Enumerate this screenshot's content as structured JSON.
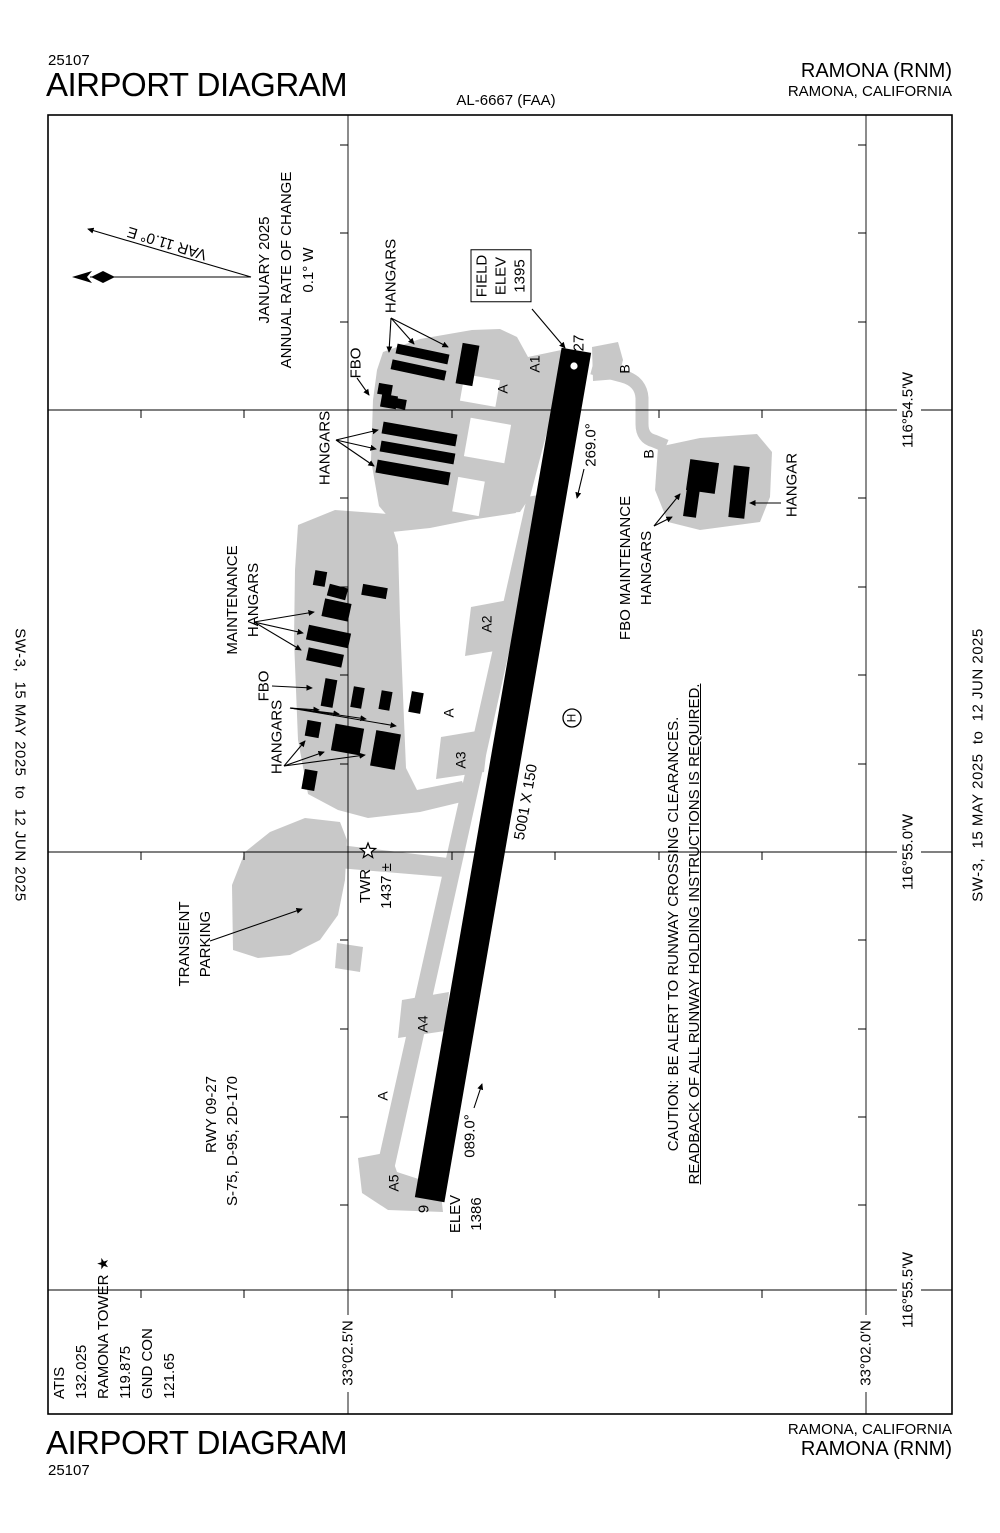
{
  "colors": {
    "paper": "#ffffff",
    "ink": "#000000",
    "apron": "#c8c8c8"
  },
  "header": {
    "chart_number": "25107",
    "title": "AIRPORT DIAGRAM",
    "al_number": "AL-6667 (FAA)",
    "airport_line": "RAMONA (RNM)",
    "city": "RAMONA, CALIFORNIA"
  },
  "footer": {
    "chart_number": "25107",
    "title": "AIRPORT DIAGRAM",
    "airport_line": "RAMONA (RNM)",
    "city": "RAMONA, CALIFORNIA"
  },
  "edges": {
    "left_date": "SW-3,  15 MAY 2025  to  12 JUN 2025",
    "right_date": "SW-3,  15 MAY 2025  to  12 JUN 2025"
  },
  "map": {
    "labels": [
      {
        "name": "annual-rate-note",
        "x": 287,
        "y": 270,
        "rot": -90,
        "size": 15,
        "align": "center",
        "lh": 22,
        "lines": [
          {
            "t": "JANUARY 2025"
          },
          {
            "t": "ANNUAL RATE OF CHANGE"
          },
          {
            "t": "0.1° W"
          }
        ]
      },
      {
        "name": "variation-label",
        "x": 167,
        "y": 243,
        "rot": -163,
        "size": 15,
        "lines": [
          {
            "t": "VAR 11.0° E"
          }
        ]
      },
      {
        "name": "fbo-north-label",
        "x": 356,
        "y": 363,
        "rot": -90,
        "size": 15,
        "lines": [
          {
            "t": "FBO"
          }
        ]
      },
      {
        "name": "hangars-north-label",
        "x": 391,
        "y": 276,
        "rot": -90,
        "size": 15,
        "lines": [
          {
            "t": "HANGARS"
          }
        ]
      },
      {
        "name": "hangars-west-label",
        "x": 325,
        "y": 448,
        "rot": -90,
        "size": 15,
        "lines": [
          {
            "t": "HANGARS"
          }
        ]
      },
      {
        "name": "maintenance-hangars-label",
        "x": 243,
        "y": 600,
        "rot": -90,
        "size": 15,
        "align": "center",
        "lh": 21,
        "lines": [
          {
            "t": "MAINTENANCE"
          },
          {
            "t": "HANGARS"
          }
        ]
      },
      {
        "name": "fbo-mid-label",
        "x": 264,
        "y": 686,
        "rot": -90,
        "size": 15,
        "lines": [
          {
            "t": "FBO"
          }
        ]
      },
      {
        "name": "hangars-mid-label",
        "x": 277,
        "y": 737,
        "rot": -90,
        "size": 15,
        "lines": [
          {
            "t": "HANGARS"
          }
        ]
      },
      {
        "name": "transient-parking-label",
        "x": 195,
        "y": 944,
        "rot": -90,
        "size": 15,
        "align": "center",
        "lh": 21,
        "lines": [
          {
            "t": "TRANSIENT"
          },
          {
            "t": "PARKING"
          }
        ]
      },
      {
        "name": "tower-label",
        "x": 376,
        "y": 886,
        "rot": -90,
        "size": 15,
        "align": "center",
        "lh": 21,
        "lines": [
          {
            "t": "TWR"
          },
          {
            "t": "1437 ±"
          }
        ]
      },
      {
        "name": "field-elev-box",
        "x": 501,
        "y": 276,
        "rot": -90,
        "size": 15,
        "align": "center",
        "lh": 19,
        "boxed": true,
        "lines": [
          {
            "t": "FIELD"
          },
          {
            "t": "ELEV"
          },
          {
            "t": "1395"
          }
        ]
      },
      {
        "name": "runway-data-label",
        "x": 222,
        "y": 1141,
        "rot": -90,
        "size": 15,
        "align": "right",
        "lh": 21,
        "lines": [
          {
            "t": "RWY 09-27"
          },
          {
            "t": "S-75, D-95, 2D-170"
          }
        ]
      },
      {
        "name": "caution-note",
        "x": 684,
        "y": 934,
        "rot": -90,
        "size": 15,
        "align": "center",
        "lh": 21,
        "lines": [
          {
            "t": "CAUTION: BE ALERT TO RUNWAY CROSSING CLEARANCES."
          },
          {
            "t": "READBACK OF ALL RUNWAY HOLDING INSTRUCTIONS IS REQUIRED.",
            "u": true
          }
        ]
      },
      {
        "name": "runway-dimension-label",
        "x": 526,
        "y": 802,
        "rot": -80,
        "size": 15,
        "lines": [
          {
            "t": "5001 X 150"
          }
        ]
      },
      {
        "name": "heading-269-label",
        "x": 591,
        "y": 445,
        "rot": -90,
        "size": 15,
        "lines": [
          {
            "t": "269.0°"
          }
        ]
      },
      {
        "name": "heading-089-label",
        "x": 470,
        "y": 1136,
        "rot": -90,
        "size": 15,
        "lines": [
          {
            "t": "089.0°"
          }
        ]
      },
      {
        "name": "threshold-27-label",
        "x": 579,
        "y": 343,
        "rot": -90,
        "size": 15,
        "lines": [
          {
            "t": "27"
          }
        ]
      },
      {
        "name": "threshold-9-label",
        "x": 424,
        "y": 1209,
        "rot": -90,
        "size": 15,
        "lines": [
          {
            "t": "9"
          }
        ]
      },
      {
        "name": "elev-9-label",
        "x": 466,
        "y": 1214,
        "rot": -90,
        "size": 15,
        "align": "center",
        "lh": 21,
        "lines": [
          {
            "t": "ELEV"
          },
          {
            "t": "1386"
          }
        ]
      },
      {
        "name": "taxiway-a1-label",
        "x": 535,
        "y": 364,
        "rot": -90,
        "size": 14,
        "lines": [
          {
            "t": "A1"
          }
        ]
      },
      {
        "name": "taxiway-a-north-label",
        "x": 503,
        "y": 389,
        "rot": -90,
        "size": 14,
        "lines": [
          {
            "t": "A"
          }
        ]
      },
      {
        "name": "taxiway-a2-label",
        "x": 487,
        "y": 624,
        "rot": -90,
        "size": 14,
        "lines": [
          {
            "t": "A2"
          }
        ]
      },
      {
        "name": "taxiway-a-mid-label",
        "x": 449,
        "y": 713,
        "rot": -90,
        "size": 14,
        "lines": [
          {
            "t": "A"
          }
        ]
      },
      {
        "name": "taxiway-a3-label",
        "x": 461,
        "y": 760,
        "rot": -90,
        "size": 14,
        "lines": [
          {
            "t": "A3"
          }
        ]
      },
      {
        "name": "taxiway-a4-label",
        "x": 423,
        "y": 1024,
        "rot": -90,
        "size": 14,
        "lines": [
          {
            "t": "A4"
          }
        ]
      },
      {
        "name": "taxiway-a-south-label",
        "x": 383,
        "y": 1096,
        "rot": -90,
        "size": 14,
        "lines": [
          {
            "t": "A"
          }
        ]
      },
      {
        "name": "taxiway-a5-label",
        "x": 394,
        "y": 1183,
        "rot": -90,
        "size": 14,
        "lines": [
          {
            "t": "A5"
          }
        ]
      },
      {
        "name": "taxiway-b-north-label",
        "x": 625,
        "y": 369,
        "rot": -90,
        "size": 14,
        "lines": [
          {
            "t": "B"
          }
        ]
      },
      {
        "name": "taxiway-b-south-label",
        "x": 649,
        "y": 454,
        "rot": -90,
        "size": 14,
        "lines": [
          {
            "t": "B"
          }
        ]
      },
      {
        "name": "helipad-h-label",
        "x": 572,
        "y": 718,
        "rot": -90,
        "size": 12,
        "lines": [
          {
            "t": "H"
          }
        ]
      },
      {
        "name": "fbo-maintenance-label",
        "x": 636,
        "y": 568,
        "rot": -90,
        "size": 15,
        "align": "center",
        "lh": 21,
        "lines": [
          {
            "t": "FBO MAINTENANCE"
          },
          {
            "t": "HANGARS"
          }
        ]
      },
      {
        "name": "se-hangar-label",
        "x": 792,
        "y": 485,
        "rot": -90,
        "size": 15,
        "lines": [
          {
            "t": "HANGAR"
          }
        ]
      },
      {
        "name": "lat-33-02-5-label",
        "x": 348,
        "y": 1353,
        "rot": -90,
        "size": 15,
        "lines": [
          {
            "t": "33°02.5′N"
          }
        ]
      },
      {
        "name": "lat-33-02-0-label",
        "x": 866,
        "y": 1353,
        "rot": -90,
        "size": 15,
        "lines": [
          {
            "t": "33°02.0′N"
          }
        ]
      },
      {
        "name": "lon-116-54-5-label",
        "x": 908,
        "y": 410,
        "rot": -90,
        "size": 15,
        "lines": [
          {
            "t": "116°54.5′W"
          }
        ]
      },
      {
        "name": "lon-116-55-0-label",
        "x": 908,
        "y": 852,
        "rot": -90,
        "size": 15,
        "lines": [
          {
            "t": "116°55.0′W"
          }
        ]
      },
      {
        "name": "lon-116-55-5-label",
        "x": 908,
        "y": 1290,
        "rot": -90,
        "size": 15,
        "lines": [
          {
            "t": "116°55.5′W"
          }
        ]
      },
      {
        "name": "comm-frequencies",
        "x": 115,
        "y": 1328,
        "rot": -90,
        "size": 15,
        "align": "left",
        "lh": 22,
        "lines": [
          {
            "t": "ATIS"
          },
          {
            "t": "132.025"
          },
          {
            "t": "RAMONA TOWER ★"
          },
          {
            "t": "119.875"
          },
          {
            "t": "GND CON"
          },
          {
            "t": "121.65"
          }
        ]
      }
    ]
  }
}
